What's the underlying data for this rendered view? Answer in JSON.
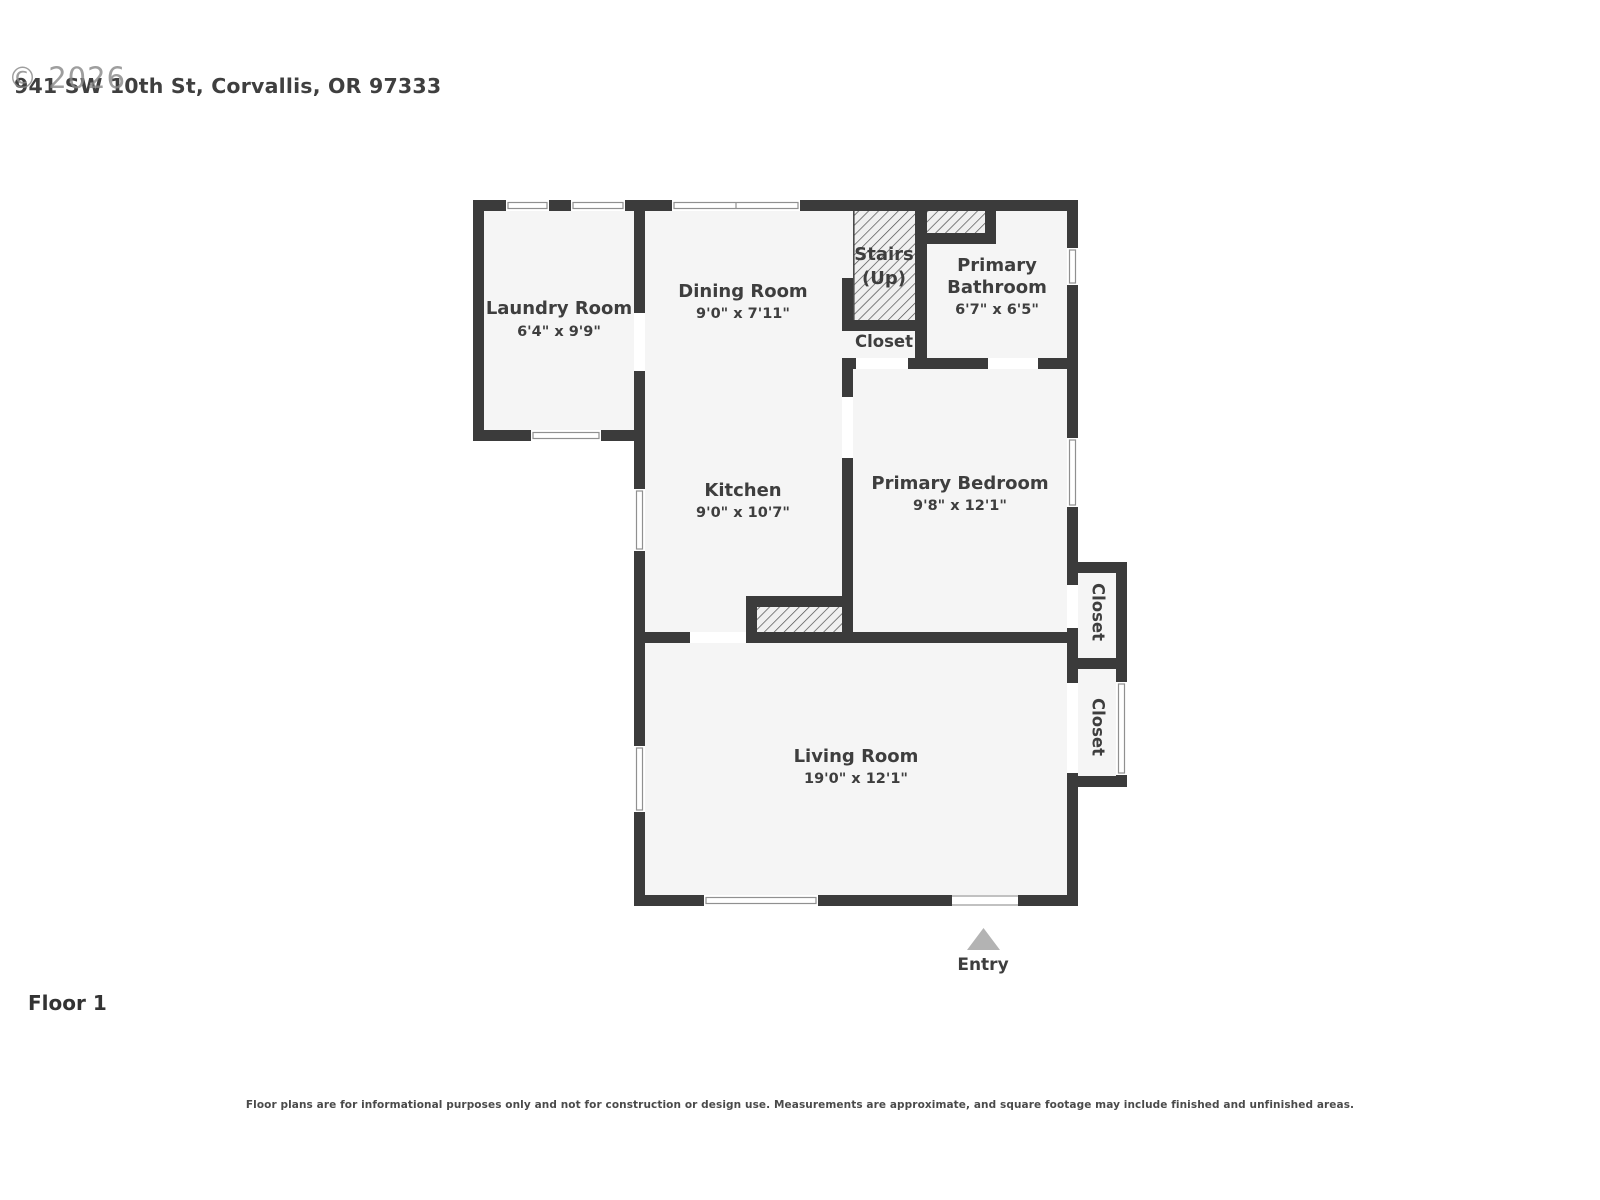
{
  "header": {
    "watermark": "© 2026",
    "address": "941 SW 10th St, Corvallis, OR 97333"
  },
  "floor_label": "Floor 1",
  "disclaimer": "Floor plans are for informational purposes only and not for construction or design use. Measurements are approximate, and square footage may include finished and unfinished areas.",
  "colors": {
    "wall": "#3b3b3b",
    "room_fill": "#f5f5f5",
    "hatch_line": "#4d4d4d",
    "text": "#3e3e3e",
    "entry_arrow": "#b3b3b3",
    "window_frame": "#909090"
  },
  "rooms": {
    "laundry": {
      "name": "Laundry Room",
      "dims": "6'4\" x 9'9\""
    },
    "dining": {
      "name": "Dining Room",
      "dims": "9'0\" x 7'11\""
    },
    "stairs": {
      "line1": "Stairs",
      "line2": "(Up)"
    },
    "stairs_closet": {
      "name": "Closet"
    },
    "bathroom": {
      "name_line1": "Primary",
      "name_line2": "Bathroom",
      "dims": "6'7\" x 6'5\""
    },
    "kitchen": {
      "name": "Kitchen",
      "dims": "9'0\" x 10'7\""
    },
    "bedroom": {
      "name": "Primary Bedroom",
      "dims": "9'8\" x 12'1\""
    },
    "closet_upper": {
      "name": "Closet"
    },
    "closet_lower": {
      "name": "Closet"
    },
    "living": {
      "name": "Living Room",
      "dims": "19'0\" x 12'1\""
    },
    "entry": {
      "name": "Entry"
    }
  }
}
